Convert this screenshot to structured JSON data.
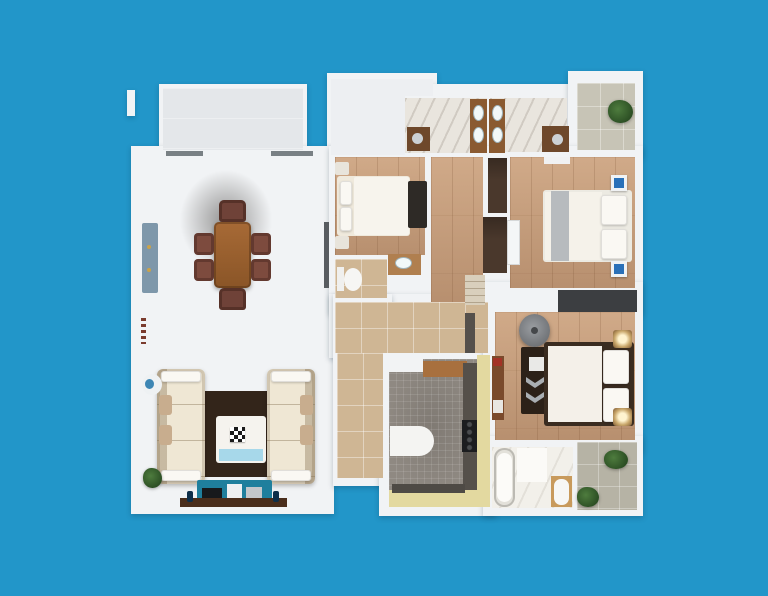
{
  "scene": {
    "type": "3d-apartment-floor-plan-top-view",
    "background_color": "#2296c9",
    "wall_color": "#f1f3f5",
    "rooms": [
      "living-dining-room",
      "bedroom-1",
      "bedroom-2",
      "master-bedroom",
      "bathroom-1",
      "bathroom-2",
      "master-bathroom",
      "wc",
      "kitchen",
      "hallway",
      "balcony-left",
      "balcony-right",
      "balcony-bottom",
      "terrace"
    ],
    "palette": {
      "wood_floor": "#c69d7b",
      "gray_tile": "#d8dad9",
      "tan_tile": "#cfb694",
      "marble": "#e9e5de",
      "kitchen_mosaic": "#8f8982",
      "kitchen_yellow": "#e3d9a0",
      "accent_blue_cabinet": "#7e97aa",
      "tv_console_teal": "#1f7f9d",
      "nightstand_blue": "#2a70b8",
      "rug_dark_brown": "#33251a",
      "dining_wood": "#9a6030"
    }
  },
  "shapes": [
    {
      "n": "outer-wall-fragment",
      "c": "wall",
      "x": 127,
      "y": 90,
      "w": 8,
      "h": 26
    },
    {
      "n": "balcony-left-walls",
      "c": "wall",
      "x": 159,
      "y": 84,
      "w": 148,
      "h": 72
    },
    {
      "n": "terrace-walls",
      "c": "wall",
      "x": 327,
      "y": 73,
      "w": 110,
      "h": 87
    },
    {
      "n": "bathrooms-walls",
      "c": "wall",
      "x": 401,
      "y": 84,
      "w": 176,
      "h": 76
    },
    {
      "n": "balcony-right-walls",
      "c": "wall",
      "x": 568,
      "y": 71,
      "w": 75,
      "h": 86
    },
    {
      "n": "living-room-walls",
      "c": "wall",
      "x": 131,
      "y": 146,
      "w": 203,
      "h": 368
    },
    {
      "n": "bedrooms-band-walls",
      "c": "wall",
      "x": 329,
      "y": 146,
      "w": 314,
      "h": 168
    },
    {
      "n": "hallway-walls",
      "c": "wall",
      "x": 329,
      "y": 294,
      "w": 166,
      "h": 64
    },
    {
      "n": "corridor-walls",
      "c": "wall",
      "x": 333,
      "y": 294,
      "w": 59,
      "h": 192
    },
    {
      "n": "kitchen-walls",
      "c": "wall",
      "x": 379,
      "y": 349,
      "w": 117,
      "h": 167
    },
    {
      "n": "master-bedroom-walls",
      "c": "wall",
      "x": 483,
      "y": 282,
      "w": 160,
      "h": 170
    },
    {
      "n": "south-block-walls",
      "c": "wall",
      "x": 483,
      "y": 436,
      "w": 160,
      "h": 80
    },
    {
      "n": "balcony-left-floor",
      "c": "courtyard",
      "x": 163,
      "y": 88,
      "w": 140,
      "h": 62
    },
    {
      "n": "terrace-floor",
      "c": "terrace",
      "x": 331,
      "y": 79,
      "w": 74,
      "h": 76
    },
    {
      "n": "terrace-floor-strip",
      "c": "terrace",
      "x": 405,
      "y": 79,
      "w": 28,
      "h": 17
    },
    {
      "n": "bathroom-1-floor",
      "c": "marble",
      "x": 405,
      "y": 98,
      "w": 82,
      "h": 55
    },
    {
      "n": "bathroom-2-floor",
      "c": "marble",
      "x": 490,
      "y": 98,
      "w": 77,
      "h": 54
    },
    {
      "n": "balcony-right-floor",
      "c": "balcony-tile",
      "x": 577,
      "y": 83,
      "w": 58,
      "h": 67
    },
    {
      "n": "bedroom-1-floor",
      "c": "wood",
      "x": 335,
      "y": 157,
      "w": 90,
      "h": 98
    },
    {
      "n": "corridor-wood-floor",
      "c": "wood",
      "x": 431,
      "y": 157,
      "w": 52,
      "h": 145
    },
    {
      "n": "bedroom-2-floor",
      "c": "wood",
      "x": 510,
      "y": 157,
      "w": 125,
      "h": 131
    },
    {
      "n": "wc-floor",
      "c": "tan",
      "x": 335,
      "y": 259,
      "w": 52,
      "h": 39
    },
    {
      "n": "hallway-floor",
      "c": "tan",
      "x": 335,
      "y": 302,
      "w": 153,
      "h": 51
    },
    {
      "n": "hallway-vertical-floor",
      "c": "tan",
      "x": 337,
      "y": 353,
      "w": 46,
      "h": 125
    },
    {
      "n": "master-bedroom-floor",
      "c": "wood",
      "x": 495,
      "y": 312,
      "w": 140,
      "h": 128
    },
    {
      "n": "kitchen-floor",
      "c": "mosaic",
      "x": 389,
      "y": 359,
      "w": 88,
      "h": 131
    },
    {
      "n": "kitchen-yellow-strip-right",
      "x": 477,
      "y": 355,
      "w": 13,
      "h": 152,
      "bg": "#e3d9a0"
    },
    {
      "n": "kitchen-yellow-strip-bottom",
      "x": 389,
      "y": 490,
      "w": 88,
      "h": 17,
      "bg": "#e3d9a0"
    },
    {
      "n": "master-bathroom-floor",
      "c": "marble-lite",
      "x": 492,
      "y": 447,
      "w": 81,
      "h": 61
    },
    {
      "n": "balcony-bottom-floor",
      "c": "balcony-tile2",
      "x": 577,
      "y": 442,
      "w": 60,
      "h": 68
    },
    {
      "n": "living-window-1",
      "x": 166,
      "y": 151,
      "w": 37,
      "h": 5,
      "bg": "#798084"
    },
    {
      "n": "living-window-2",
      "x": 271,
      "y": 151,
      "w": 42,
      "h": 5,
      "bg": "#798084"
    },
    {
      "n": "living-east-doorway",
      "x": 324,
      "y": 222,
      "w": 5,
      "h": 66,
      "bg": "#585c60"
    },
    {
      "n": "living-wall-vent",
      "c": "dashes",
      "x": 141,
      "y": 318,
      "w": 5,
      "h": 26
    },
    {
      "n": "blue-sideboard",
      "x": 142,
      "y": 223,
      "w": 16,
      "h": 70,
      "bg": "#7e97aa",
      "r": 2
    },
    {
      "n": "sideboard-knob-1",
      "x": 147,
      "y": 245,
      "w": 4,
      "h": 4,
      "bg": "#c9a24a",
      "r": "50%"
    },
    {
      "n": "sideboard-knob-2",
      "x": 147,
      "y": 268,
      "w": 4,
      "h": 4,
      "bg": "#c9a24a",
      "r": "50%"
    },
    {
      "n": "dining-ceiling-shadow",
      "c": "shadow",
      "x": 178,
      "y": 168,
      "w": 96,
      "h": 104
    },
    {
      "n": "dining-table",
      "c": "table",
      "x": 214,
      "y": 222,
      "w": 37,
      "h": 66,
      "r": 5
    },
    {
      "n": "dining-chair-north",
      "c": "chairA",
      "x": 219,
      "y": 200,
      "w": 27,
      "h": 22
    },
    {
      "n": "dining-chair-south",
      "c": "chairA",
      "x": 219,
      "y": 288,
      "w": 27,
      "h": 22
    },
    {
      "n": "dining-chair-west-1",
      "c": "chairB",
      "x": 194,
      "y": 233,
      "w": 20,
      "h": 22
    },
    {
      "n": "dining-chair-west-2",
      "c": "chairB",
      "x": 194,
      "y": 259,
      "w": 20,
      "h": 22
    },
    {
      "n": "dining-chair-east-1",
      "c": "chairB",
      "x": 251,
      "y": 233,
      "w": 20,
      "h": 22
    },
    {
      "n": "dining-chair-east-2",
      "c": "chairB",
      "x": 251,
      "y": 259,
      "w": 20,
      "h": 22
    },
    {
      "n": "living-area-rug",
      "x": 196,
      "y": 391,
      "w": 78,
      "h": 86,
      "bg": "#33251a"
    },
    {
      "n": "sofa-left",
      "c": "sofa sofa-l",
      "x": 157,
      "y": 369,
      "w": 48,
      "h": 115,
      "r": 6
    },
    {
      "n": "sofa-right",
      "c": "sofa sofa-r",
      "x": 267,
      "y": 369,
      "w": 48,
      "h": 115,
      "r": 6
    },
    {
      "n": "sofa-left-pillow-top",
      "c": "pillow",
      "x": 161,
      "y": 371,
      "w": 40,
      "h": 11
    },
    {
      "n": "sofa-left-pillow-bottom",
      "c": "pillow",
      "x": 161,
      "y": 470,
      "w": 40,
      "h": 11
    },
    {
      "n": "sofa-right-pillow-top",
      "c": "pillow",
      "x": 271,
      "y": 371,
      "w": 40,
      "h": 11
    },
    {
      "n": "sofa-right-pillow-bottom",
      "c": "pillow",
      "x": 271,
      "y": 470,
      "w": 40,
      "h": 11
    },
    {
      "n": "sofa-left-cushion-1",
      "x": 159,
      "y": 395,
      "w": 13,
      "h": 20,
      "bg": "#c8ad8e",
      "r": 3
    },
    {
      "n": "sofa-left-cushion-2",
      "x": 159,
      "y": 425,
      "w": 13,
      "h": 20,
      "bg": "#c8ad8e",
      "r": 3
    },
    {
      "n": "sofa-right-cushion-1",
      "x": 300,
      "y": 395,
      "w": 13,
      "h": 20,
      "bg": "#c8ad8e",
      "r": 3
    },
    {
      "n": "sofa-right-cushion-2",
      "x": 300,
      "y": 425,
      "w": 13,
      "h": 20,
      "bg": "#c8ad8e",
      "r": 3
    },
    {
      "n": "coffee-table",
      "x": 216,
      "y": 416,
      "w": 50,
      "h": 47,
      "bg": "#f5f3ee",
      "r": 3
    },
    {
      "n": "coffee-table-blue-tray",
      "x": 219,
      "y": 449,
      "w": 44,
      "h": 12,
      "bg": "#a7d8ea"
    },
    {
      "n": "chessboard",
      "c": "checker",
      "x": 230,
      "y": 427,
      "w": 15,
      "h": 15
    },
    {
      "n": "round-side-table",
      "x": 142,
      "y": 374,
      "w": 20,
      "h": 21,
      "bg": "#eef1f3",
      "r": "50%"
    },
    {
      "n": "round-table-blue-accent",
      "x": 145,
      "y": 379,
      "w": 9,
      "h": 10,
      "bg": "#3d86b4",
      "r": "50%"
    },
    {
      "n": "living-plant",
      "c": "plant",
      "x": 143,
      "y": 468,
      "w": 19,
      "h": 20
    },
    {
      "n": "tv-console",
      "x": 197,
      "y": 480,
      "w": 75,
      "h": 21,
      "bg": "#1f7f9d",
      "r": 2
    },
    {
      "n": "tv-screen",
      "x": 202,
      "y": 488,
      "w": 20,
      "h": 11,
      "bg": "#17191c"
    },
    {
      "n": "console-speaker",
      "x": 227,
      "y": 484,
      "w": 15,
      "h": 18,
      "bg": "#eef0f2"
    },
    {
      "n": "console-panel",
      "x": 246,
      "y": 487,
      "w": 16,
      "h": 13,
      "bg": "#c3c7cb"
    },
    {
      "n": "console-wood-shelf",
      "x": 180,
      "y": 498,
      "w": 107,
      "h": 9,
      "bg": "#4a2e1c"
    },
    {
      "n": "console-vase-left",
      "x": 187,
      "y": 491,
      "w": 6,
      "h": 11,
      "bg": "#0e2f4a",
      "r": 2
    },
    {
      "n": "console-vase-right",
      "x": 273,
      "y": 491,
      "w": 6,
      "h": 11,
      "bg": "#0e2f4a",
      "r": 2
    },
    {
      "n": "bedroom-1-nightstand-top",
      "x": 335,
      "y": 162,
      "w": 14,
      "h": 13,
      "bg": "#e8e4db",
      "r": 2
    },
    {
      "n": "bedroom-1-nightstand-bottom",
      "x": 335,
      "y": 236,
      "w": 14,
      "h": 13,
      "bg": "#e8e4db",
      "r": 2
    },
    {
      "n": "bedroom-1-bed",
      "x": 337,
      "y": 176,
      "w": 73,
      "h": 60,
      "bg": "#efe9dc",
      "r": 3
    },
    {
      "n": "bedroom-1-duvet",
      "x": 354,
      "y": 177,
      "w": 55,
      "h": 58,
      "bg": "#f7f4ed",
      "r": 2
    },
    {
      "n": "bedroom-1-pillow-1",
      "c": "pillow",
      "x": 340,
      "y": 181,
      "w": 12,
      "h": 24
    },
    {
      "n": "bedroom-1-pillow-2",
      "c": "pillow",
      "x": 340,
      "y": 207,
      "w": 12,
      "h": 24
    },
    {
      "n": "bedroom-1-rug",
      "x": 408,
      "y": 181,
      "w": 19,
      "h": 47,
      "bg": "#2e2a26",
      "r": 2
    },
    {
      "n": "wardrobe-upper",
      "c": "darkwood",
      "x": 488,
      "y": 158,
      "w": 19,
      "h": 55
    },
    {
      "n": "wardrobe-lower",
      "c": "darkwood",
      "x": 483,
      "y": 217,
      "w": 24,
      "h": 56
    },
    {
      "n": "sliding-door-white",
      "c": "white-box",
      "x": 507,
      "y": 220,
      "w": 13,
      "h": 45
    },
    {
      "n": "closet-shelves",
      "c": "shelves",
      "x": 465,
      "y": 275,
      "w": 20,
      "h": 30
    },
    {
      "n": "hallway-door-mat",
      "x": 465,
      "y": 313,
      "w": 10,
      "h": 40,
      "bg": "#55504b"
    },
    {
      "n": "master-wardrobe-strip",
      "x": 558,
      "y": 290,
      "w": 79,
      "h": 22,
      "bg": "#3c3e41"
    },
    {
      "n": "bedroom-2-dresser",
      "x": 544,
      "y": 157,
      "w": 26,
      "h": 7,
      "bg": "#f0f1f2"
    },
    {
      "n": "bedroom-2-bed",
      "x": 543,
      "y": 190,
      "w": 89,
      "h": 72,
      "bg": "#eceae2",
      "r": 3
    },
    {
      "n": "bedroom-2-duvet",
      "x": 545,
      "y": 192,
      "w": 57,
      "h": 68,
      "bg": "#f5f2ea"
    },
    {
      "n": "bedroom-2-runner",
      "x": 551,
      "y": 191,
      "w": 18,
      "h": 70,
      "bg": "#b7bbbe"
    },
    {
      "n": "bedroom-2-pillow-1",
      "c": "pillow",
      "x": 601,
      "y": 195,
      "w": 26,
      "h": 30
    },
    {
      "n": "bedroom-2-pillow-2",
      "c": "pillow",
      "x": 601,
      "y": 229,
      "w": 26,
      "h": 30
    },
    {
      "n": "bedroom-2-nightstand-blue-top",
      "c": "blue-ns",
      "x": 611,
      "y": 175,
      "w": 16,
      "h": 16
    },
    {
      "n": "bedroom-2-nightstand-blue-bottom",
      "c": "blue-ns",
      "x": 611,
      "y": 261,
      "w": 16,
      "h": 16
    },
    {
      "n": "papasan-chair",
      "c": "papasan",
      "x": 519,
      "y": 314,
      "w": 31,
      "h": 33,
      "r": "50%"
    },
    {
      "n": "papasan-center",
      "x": 531,
      "y": 327,
      "w": 7,
      "h": 7,
      "bg": "#45474a",
      "r": "50%"
    },
    {
      "n": "master-dresser",
      "x": 521,
      "y": 347,
      "w": 31,
      "h": 67,
      "bg": "#2c2118",
      "r": 2
    },
    {
      "n": "master-dresser-frame",
      "x": 529,
      "y": 357,
      "w": 16,
      "h": 14,
      "bg": "#e9e9e7"
    },
    {
      "n": "master-dresser-chevron-1",
      "c": "chev",
      "x": 526,
      "y": 377,
      "w": 18,
      "h": 11
    },
    {
      "n": "master-dresser-chevron-2",
      "c": "chev",
      "x": 526,
      "y": 392,
      "w": 18,
      "h": 11
    },
    {
      "n": "master-bed-frame",
      "x": 544,
      "y": 342,
      "w": 90,
      "h": 84,
      "bg": "#3a2c20",
      "r": 3
    },
    {
      "n": "master-bed-duvet",
      "x": 548,
      "y": 346,
      "w": 54,
      "h": 76,
      "bg": "#f4f0e9"
    },
    {
      "n": "master-pillow-1",
      "c": "pillow",
      "x": 603,
      "y": 350,
      "w": 26,
      "h": 34
    },
    {
      "n": "master-pillow-2",
      "c": "pillow",
      "x": 603,
      "y": 388,
      "w": 26,
      "h": 34
    },
    {
      "n": "master-nightstand-lamp-top",
      "c": "lamp",
      "x": 613,
      "y": 330,
      "w": 19,
      "h": 18
    },
    {
      "n": "master-nightstand-lamp-bottom",
      "c": "lamp",
      "x": 613,
      "y": 408,
      "w": 19,
      "h": 18
    },
    {
      "n": "master-console",
      "x": 492,
      "y": 356,
      "w": 12,
      "h": 64,
      "bg": "#7a4a2c"
    },
    {
      "n": "master-console-red-box",
      "x": 493,
      "y": 358,
      "w": 9,
      "h": 8,
      "bg": "#a33226"
    },
    {
      "n": "master-console-drawer",
      "x": 493,
      "y": 400,
      "w": 10,
      "h": 13,
      "bg": "#e8e6e1"
    },
    {
      "n": "kitchen-fridge",
      "x": 389,
      "y": 358,
      "w": 34,
      "h": 14,
      "bg": "#f2f3f4"
    },
    {
      "n": "kitchen-wood-counter",
      "x": 423,
      "y": 361,
      "w": 44,
      "h": 16,
      "bg": "#a8703e"
    },
    {
      "n": "kitchen-dark-counter",
      "x": 463,
      "y": 363,
      "w": 14,
      "h": 127,
      "bg": "#55504a"
    },
    {
      "n": "kitchen-cooktop",
      "c": "burners",
      "x": 462,
      "y": 420,
      "w": 15,
      "h": 32
    },
    {
      "n": "kitchen-peninsula",
      "x": 390,
      "y": 426,
      "w": 44,
      "h": 30,
      "bg": "#f4f4f2",
      "r": "0 16px 16px 0"
    },
    {
      "n": "kitchen-base-cabinet",
      "x": 392,
      "y": 484,
      "w": 73,
      "h": 9,
      "bg": "#4e4a45"
    },
    {
      "n": "bathroom-1-vanity",
      "x": 407,
      "y": 127,
      "w": 23,
      "h": 24,
      "bg": "#6e482b"
    },
    {
      "n": "bathroom-1-sink",
      "x": 412,
      "y": 133,
      "w": 11,
      "h": 11,
      "bg": "#ccd1d5",
      "r": "50%"
    },
    {
      "n": "bathroom-1-basin-strip",
      "x": 470,
      "y": 99,
      "w": 17,
      "h": 54,
      "bg": "#8a5a31"
    },
    {
      "n": "bathroom-1-basin-1",
      "c": "basin",
      "x": 473,
      "y": 105,
      "w": 11,
      "h": 16
    },
    {
      "n": "bathroom-1-basin-2",
      "c": "basin",
      "x": 473,
      "y": 127,
      "w": 11,
      "h": 16
    },
    {
      "n": "bathroom-2-basin-strip",
      "x": 489,
      "y": 99,
      "w": 16,
      "h": 54,
      "bg": "#8a5a31"
    },
    {
      "n": "bathroom-2-basin-1",
      "c": "basin",
      "x": 492,
      "y": 105,
      "w": 11,
      "h": 16
    },
    {
      "n": "bathroom-2-basin-2",
      "c": "basin",
      "x": 492,
      "y": 127,
      "w": 11,
      "h": 16
    },
    {
      "n": "bathroom-2-vanity",
      "x": 542,
      "y": 126,
      "w": 27,
      "h": 26,
      "bg": "#6e482b"
    },
    {
      "n": "bathroom-2-sink",
      "x": 552,
      "y": 134,
      "w": 11,
      "h": 11,
      "bg": "#ccd1d5",
      "r": "50%"
    },
    {
      "n": "wc-toilet-tank",
      "x": 337,
      "y": 267,
      "w": 7,
      "h": 24,
      "bg": "#f0f0ee"
    },
    {
      "n": "wc-toilet-bowl",
      "x": 344,
      "y": 268,
      "w": 18,
      "h": 23,
      "bg": "#f6f6f4",
      "r": "50%"
    },
    {
      "n": "wc-niche-vanity",
      "x": 388,
      "y": 254,
      "w": 33,
      "h": 21,
      "bg": "#b07f4f"
    },
    {
      "n": "wc-niche-sink",
      "c": "basin",
      "x": 395,
      "y": 257,
      "w": 17,
      "h": 12
    },
    {
      "n": "master-bath-tub",
      "c": "tub",
      "x": 494,
      "y": 448,
      "w": 21,
      "h": 59,
      "r": 10
    },
    {
      "n": "master-bath-tub-inner",
      "x": 497,
      "y": 453,
      "w": 15,
      "h": 49,
      "bg": "#fcfbf8",
      "r": 8
    },
    {
      "n": "master-bath-shower-mat",
      "x": 517,
      "y": 448,
      "w": 30,
      "h": 34,
      "bg": "#fbfaf7"
    },
    {
      "n": "master-bath-toilet-mat",
      "x": 551,
      "y": 476,
      "w": 21,
      "h": 31,
      "bg": "#c89a5c"
    },
    {
      "n": "master-bath-toilet",
      "x": 554,
      "y": 479,
      "w": 15,
      "h": 26,
      "bg": "#f7f7f5",
      "r": 7
    },
    {
      "n": "balcony-right-plant",
      "c": "plant",
      "x": 608,
      "y": 100,
      "w": 25,
      "h": 23
    },
    {
      "n": "balcony-bottom-plant-1",
      "c": "plant",
      "x": 604,
      "y": 450,
      "w": 24,
      "h": 19
    },
    {
      "n": "balcony-bottom-plant-2",
      "c": "plant",
      "x": 577,
      "y": 487,
      "w": 22,
      "h": 20
    }
  ]
}
